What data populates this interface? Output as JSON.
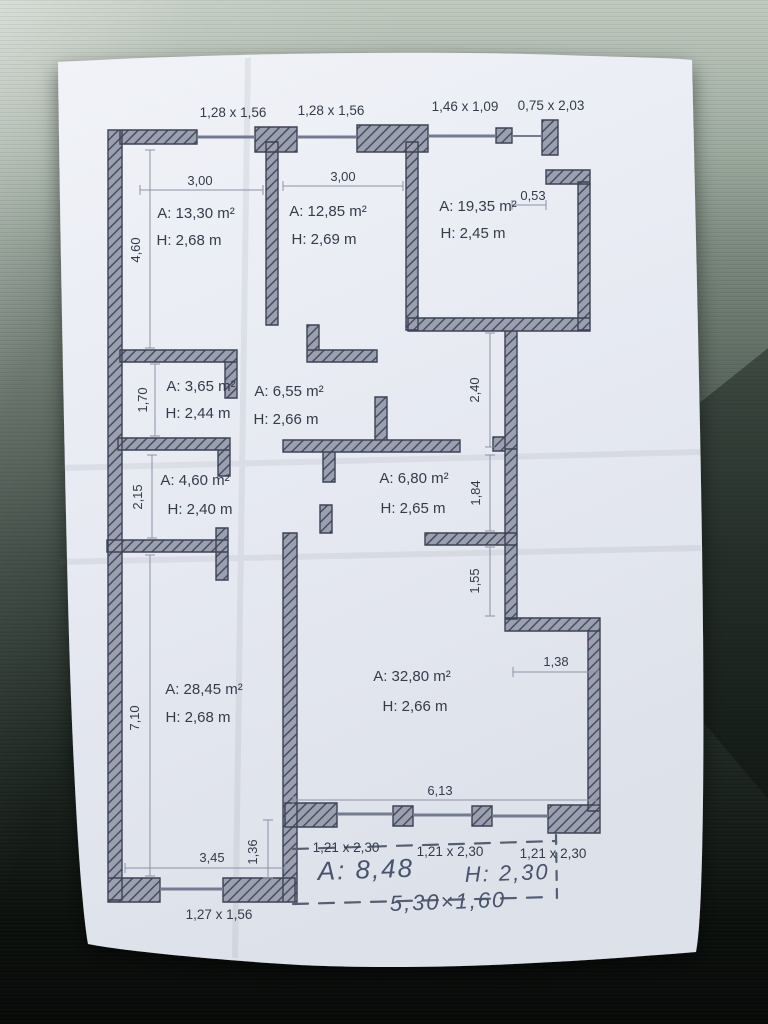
{
  "photo": {
    "subject": "paper floor plan photographed on dark textured table",
    "paper_color": "#e9ecf3",
    "wall_fill": "#9aa0af",
    "wall_hatch": "#474e60",
    "ink": "#343b4a",
    "pencil_ink": "#49536b"
  },
  "plan": {
    "top_openings": [
      "1,28 x 1,56",
      "1,28 x 1,56",
      "1,46 x 1,09",
      "0,75 x 2,03"
    ],
    "rooms": [
      {
        "area": "A: 13,30 m²",
        "height": "H: 2,68 m"
      },
      {
        "area": "A: 12,85 m²",
        "height": "H: 2,69 m"
      },
      {
        "area": "A: 19,35 m²",
        "height": "H: 2,45 m"
      },
      {
        "area": "A: 3,65 m²",
        "height": "H: 2,44 m"
      },
      {
        "area": "A: 6,55 m²",
        "height": "H: 2,66 m"
      },
      {
        "area": "A: 4,60 m²",
        "height": "H: 2,40 m"
      },
      {
        "area": "A: 6,80 m²",
        "height": "H: 2,65 m"
      },
      {
        "area": "A: 28,45 m²",
        "height": "H: 2,68 m"
      },
      {
        "area": "A: 32,80 m²",
        "height": "H: 2,66 m"
      }
    ],
    "dims": {
      "room1_w": "3,00",
      "room2_w": "3,00",
      "niche": "0,53",
      "room1_h": "4,60",
      "small1_h": "1,70",
      "small2_h": "2,15",
      "left_room_h": "7,10",
      "hall_r1": "2,40",
      "hall_r2": "1,84",
      "hall_r3": "1,55",
      "step_w": "1,38",
      "big_room_w": "6,13",
      "left_bottom_w": "3,45",
      "offset": "1,36"
    },
    "bottom_windows": [
      "1,21 x 2,30",
      "1,21 x 2,30",
      "1,21 x 2,30"
    ],
    "bottom_left_window": "1,27 x 1,56",
    "handwriting": {
      "area": "A: 8,48",
      "height": "H: 2,30",
      "size": "5,30×1,60"
    }
  }
}
